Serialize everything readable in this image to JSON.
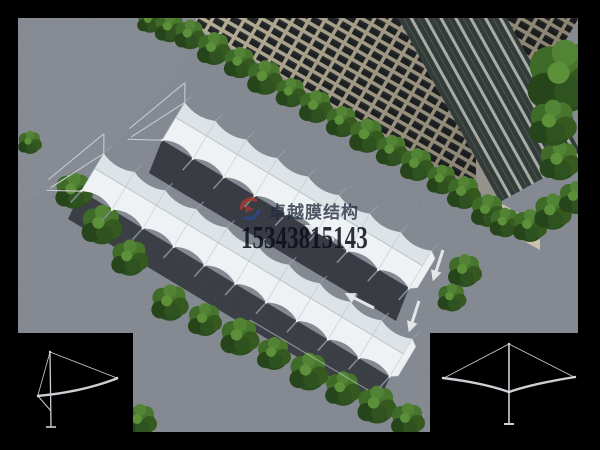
{
  "image": {
    "kind": "3d-architectural-rendering",
    "subject": "aerial view of two rows of white tensile-membrane carports on gray pavement beside a high-rise building lined with trees"
  },
  "watermark": {
    "brand": "卓越膜结构",
    "phone": "15343815143",
    "logo_red": "#b23a2e",
    "logo_blue": "#2c4a8c"
  },
  "scene_colors": {
    "background": "#000000",
    "pavement": "#7e838d",
    "canopy": "#eff2f4",
    "canopy_far_slope": "#dde3e6",
    "canopy_shadow": "#35383f",
    "tree_green": "#3a6326",
    "building_frame": "#b7ae96",
    "building_window": "#222527",
    "glass_facade": "#3c4541",
    "inset_line": "#cdd1d5"
  },
  "insets": {
    "left_drawing": "single-cantilever-frame-elevation",
    "right_drawing": "double-cantilever-frame-elevation"
  }
}
